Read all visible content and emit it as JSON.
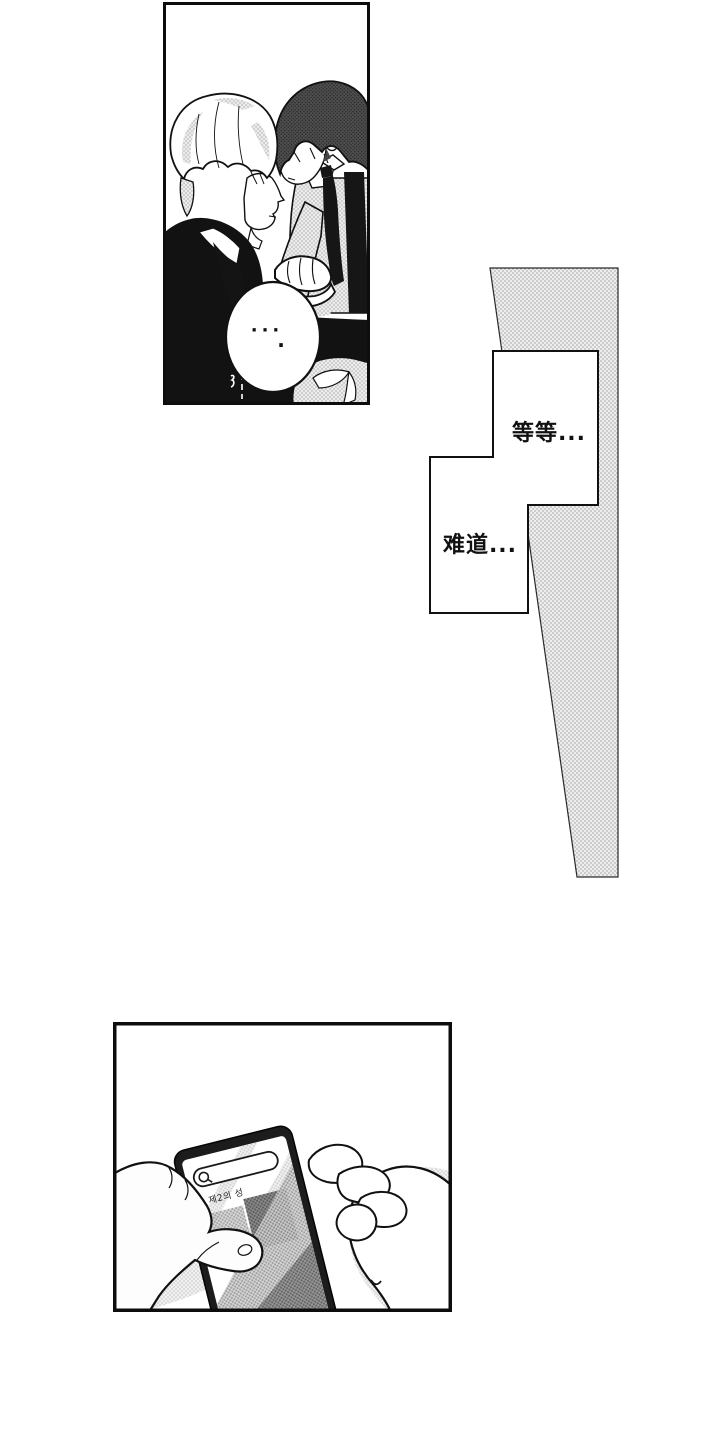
{
  "colors": {
    "ink": "#111111",
    "paper": "#ffffff",
    "halftone_light": "#d9d9d9",
    "halftone_dark": "#6b6b6b"
  },
  "panel_couple": {
    "speech_bubble": {
      "dots": "···",
      "extra_dot": "·"
    }
  },
  "narration_boxes": [
    {
      "text": "等等..."
    },
    {
      "text": "难道..."
    }
  ],
  "panel_phone": {
    "search_bar": {
      "icon": "magnifying-glass",
      "query_text": "제2의 성"
    },
    "wrist_mark": "small-u-curve"
  }
}
